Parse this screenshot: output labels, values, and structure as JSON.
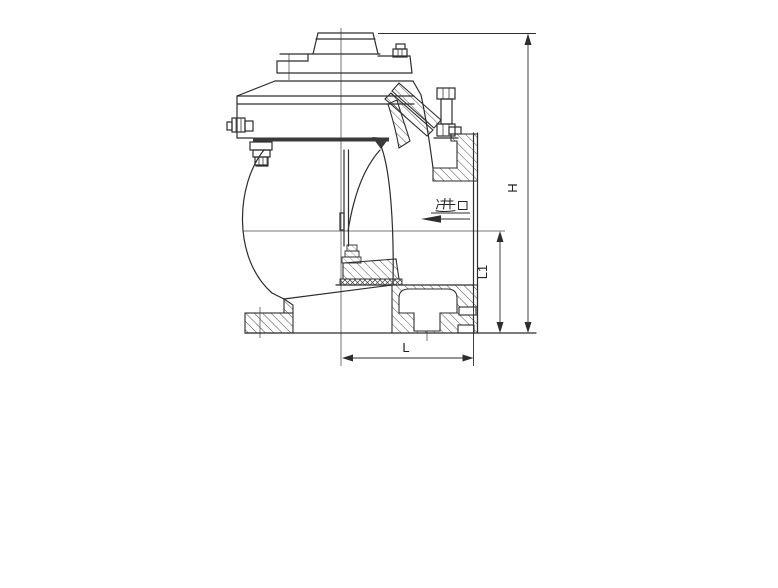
{
  "figure": {
    "type": "technical-drawing-valve-cross-section",
    "annotations": {
      "inlet_label": "进口",
      "dim_overall_height": "H",
      "dim_center_height": "L1",
      "dim_length": "L"
    },
    "colors": {
      "line": "#2d2d2d",
      "background": "#ffffff",
      "diaphragm_band": "#3a3a3a"
    }
  }
}
